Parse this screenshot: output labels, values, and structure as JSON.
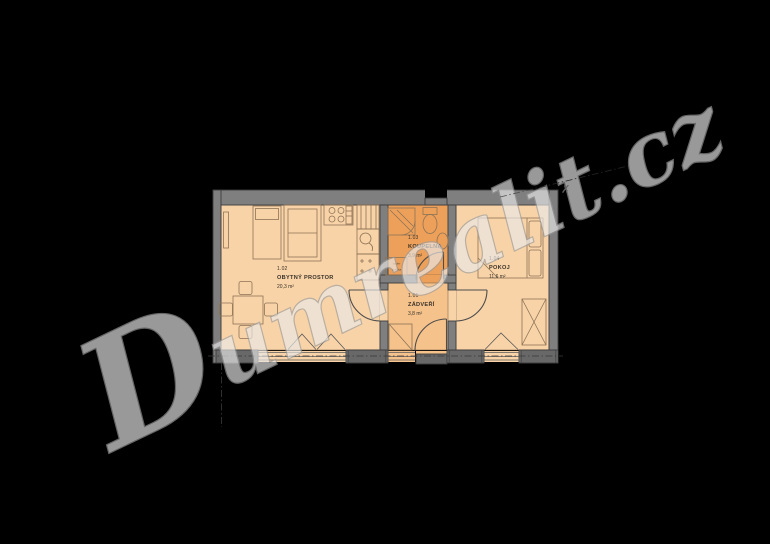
{
  "watermark": {
    "text_main": "D",
    "text_rest": "umrealit.cz",
    "full_text": "Dumrealit.cz",
    "cross_mark": "✗"
  },
  "colors": {
    "background": "#000000",
    "room_light": "#f8d3a8",
    "hall": "#f5c28c",
    "bath": "#eda05a",
    "wall": "#7f7f7f",
    "wall_dark": "#686868",
    "threshold": "#5e5e5e",
    "furniture_line": "#8d7355",
    "label_text": "#3a3228",
    "watermark_fill": "#e9e9e9",
    "watermark_stroke": "#9b9b9b"
  },
  "rooms": {
    "living": {
      "id": "1.02",
      "name": "OBYTNÝ PROSTOR",
      "area": "20,3 m²"
    },
    "bathroom": {
      "id": "1.03",
      "name": "KOUPELNA",
      "area": "3,9 m²"
    },
    "hall": {
      "id": "1.01",
      "name": "ZÁDVEŘÍ",
      "area": "3,8 m²"
    },
    "bedroom": {
      "id": "1.04",
      "name": "POKOJ",
      "area": "11,6 m²"
    }
  },
  "appliance_box": {
    "line1": "bojler",
    "line2": "pračka"
  }
}
